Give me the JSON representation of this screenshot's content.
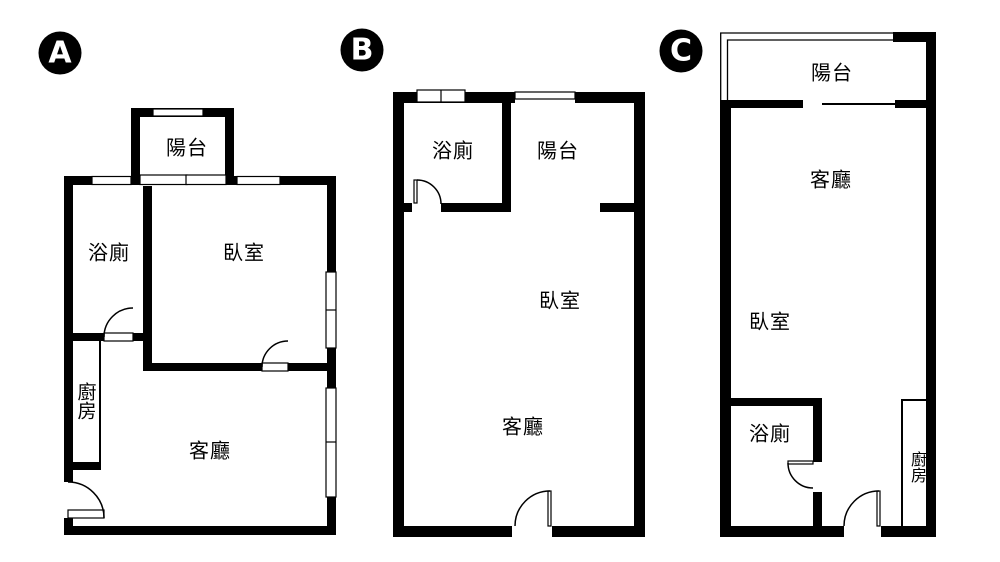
{
  "title": "three-unit floor plan comparison",
  "colors": {
    "wall": "#000000",
    "background": "#ffffff",
    "badge_bg": "#000000",
    "badge_text": "#ffffff"
  },
  "plans": [
    {
      "badge": "A",
      "rooms": {
        "balcony": "陽台",
        "bathroom": "浴廁",
        "bedroom": "臥室",
        "kitchen": "廚房",
        "living": "客廳"
      }
    },
    {
      "badge": "B",
      "rooms": {
        "bathroom": "浴廁",
        "balcony": "陽台",
        "bedroom": "臥室",
        "living": "客廳"
      }
    },
    {
      "badge": "C",
      "rooms": {
        "balcony": "陽台",
        "living": "客廳",
        "bedroom": "臥室",
        "bathroom": "浴廁",
        "kitchen": "廚房"
      }
    }
  ]
}
